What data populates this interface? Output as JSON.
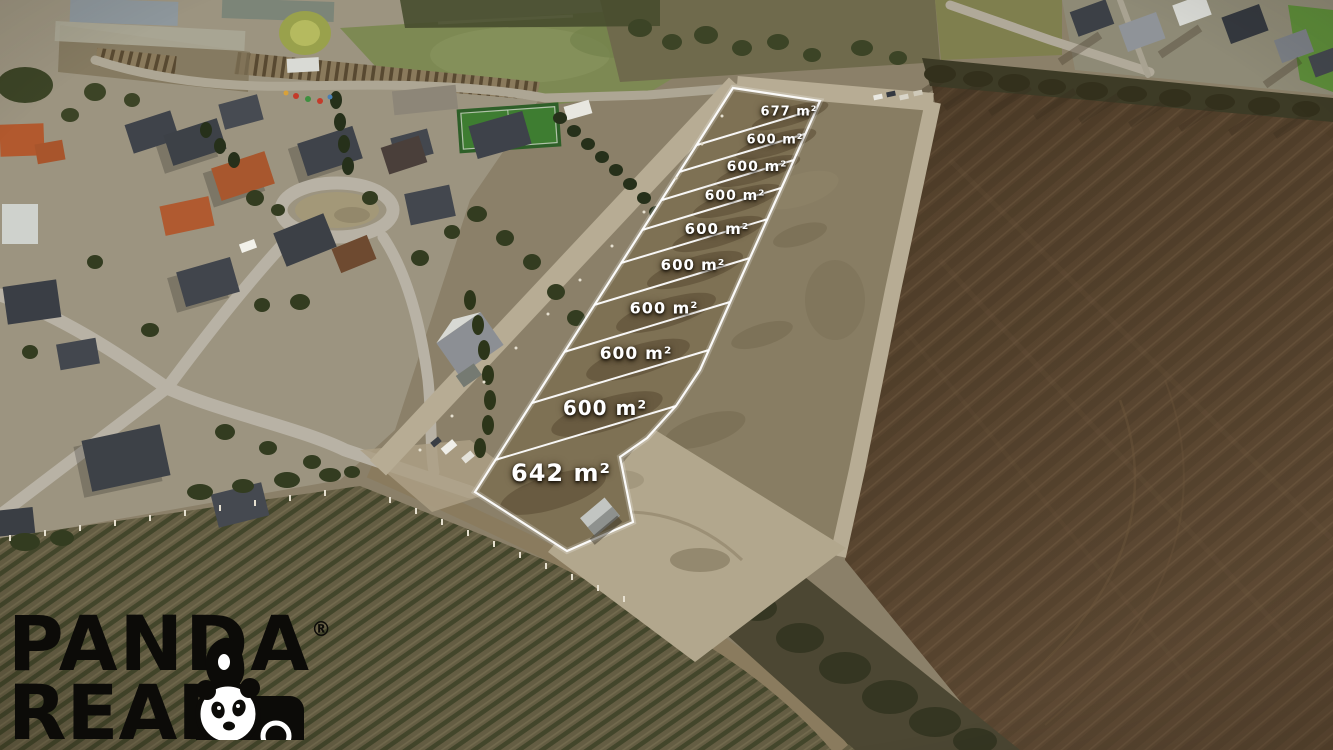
{
  "plot_labels": [
    {
      "area": "677 m²",
      "x": 789,
      "y": 112,
      "font": 13
    },
    {
      "area": "600 m²",
      "x": 775,
      "y": 140,
      "font": 13
    },
    {
      "area": "600 m²",
      "x": 757,
      "y": 167,
      "font": 14
    },
    {
      "area": "600 m²",
      "x": 735,
      "y": 196,
      "font": 14
    },
    {
      "area": "600 m²",
      "x": 717,
      "y": 229,
      "font": 15
    },
    {
      "area": "600 m²",
      "x": 693,
      "y": 265,
      "font": 15
    },
    {
      "area": "600 m²",
      "x": 664,
      "y": 308,
      "font": 16
    },
    {
      "area": "600 m²",
      "x": 636,
      "y": 354,
      "font": 17
    },
    {
      "area": "600 m²",
      "x": 605,
      "y": 408,
      "font": 20
    },
    {
      "area": "642 m²",
      "x": 561,
      "y": 473,
      "font": 24
    }
  ],
  "logo": {
    "line1": "PANDA",
    "registered": "®",
    "line2": "REAL",
    "icon": "panda-face-icon"
  },
  "colors": {
    "plot_line": "#ffffff",
    "label_text": "#ffffff",
    "logo_text": "#0c0b08"
  }
}
